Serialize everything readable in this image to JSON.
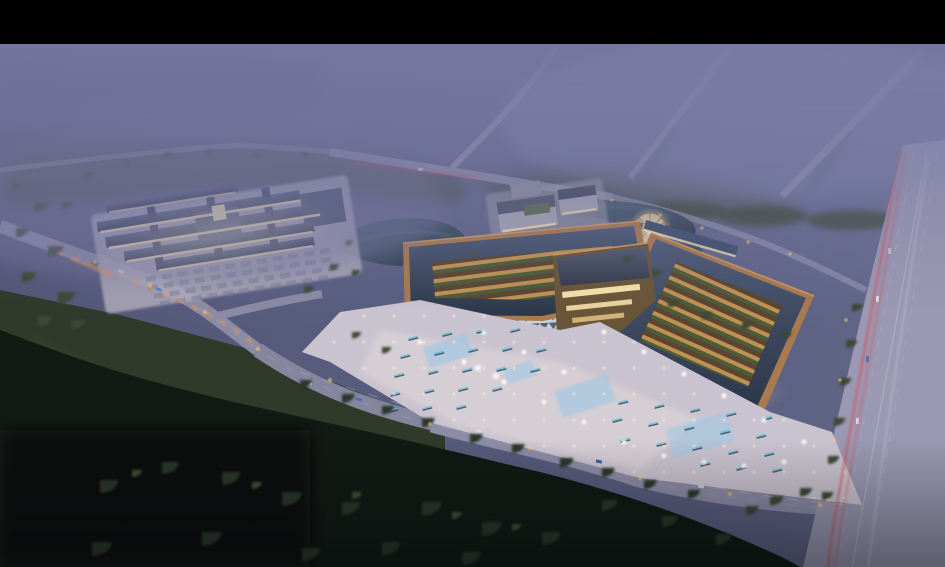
{
  "image_type": "aerial-architectural-rendering",
  "scene": {
    "regions": [
      "letterbox-top-bar",
      "sky-haze",
      "farmland-upper-right",
      "distant-forest-band",
      "green-field-lower-left",
      "dense-forest-bottom",
      "road-network",
      "highway-right",
      "front-road",
      "crossroad-top",
      "farm-road-a",
      "farm-road-b",
      "pond-west",
      "pond-east",
      "left-campus",
      "top-cluster-buildings",
      "circular-pavilion",
      "row-buildings-east",
      "main-complex",
      "left-pavilion",
      "right-pavilion",
      "central-hall",
      "plaza-parking",
      "parking-canopy-strips",
      "water-pools",
      "trees",
      "light-trails",
      "street-lights",
      "fog-overlay"
    ]
  },
  "palette": {
    "letterbox_black": "#000000",
    "sky_top": "#75779f",
    "sky_mid": "#64688c",
    "sky_low": "#565b7b",
    "haze": "#7476a0",
    "haze_right": "#8588ae",
    "distant_forest": "#45503f",
    "field_green": "#2f3a2a",
    "forest_dark": "#121a14",
    "forest_deep": "#0c110d",
    "tree_dark": "#2c3829",
    "tree_mid": "#3c4a35",
    "tree_light": "#4a583d",
    "road_light": "#9a98b2",
    "road_mid": "#8d8ca6",
    "road_lane": "#bab8cc",
    "plaza": "#c9c3cf",
    "plaza_bright": "#ded6d8",
    "pond_hi": "#4c5f73",
    "pond_lo": "#333f4e",
    "roof_slate_hi": "#4e5b76",
    "roof_slate_lo": "#2d374a",
    "roof_blue_row": "#42506e",
    "copper": "#a9794f",
    "copper_bright": "#d29a62",
    "courtyard_dark": "#33291d",
    "courtyard_beam": "#5c4832",
    "courtyard_amber": "#c79655",
    "courtyard_green": "#4e5f3a",
    "sawtooth_teal": "#3f4f66",
    "band_light": "#ccd3dc",
    "facade_warm": "#f0ddae",
    "window_hot": "#ffe9b0",
    "wall_gray": "#a3a3b0",
    "roof_gray": "#50566a",
    "teal_strip": "#57c6da",
    "pool_blue": "#a2c6e2",
    "trail_red": "#e4454e",
    "trail_orange": "#ff9a3e",
    "trail_white": "#eceafc",
    "lamp_amber": "#ffc36a",
    "lamp_white": "#fff6dd",
    "pavilion_ring": "#cdbd9b",
    "pavilion_hub": "#f2e4ba"
  }
}
